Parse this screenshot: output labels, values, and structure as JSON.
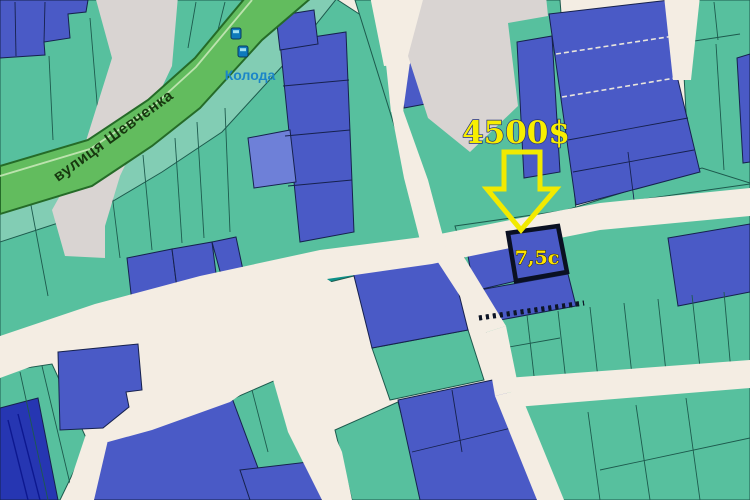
{
  "map": {
    "labels": {
      "street": "вулиця Шевченка",
      "place": "Колода",
      "price": "4500$",
      "area": "7,5с"
    },
    "colors": {
      "blue": "#4a5ac6",
      "blue_light": "#6e80d8",
      "blue_dark": "#2636b2",
      "navy_line": "#16214d",
      "green": "#57c09e",
      "green_hl": "#82cdb4",
      "green_dark": "#0c9189",
      "green_line": "#1d5a4d",
      "road": "#f4ede3",
      "road_gray": "#d9d4d2",
      "band": "#62bc5e",
      "band_edge": "#256b28",
      "band_light": "#cdeabc",
      "street_text": "#17380f",
      "place_text": "#1b86c8",
      "price_fill": "#f8ee00",
      "price_outline": "#22307c",
      "arrow_yellow": "#f2ea00",
      "hatch": "#0d1526",
      "white_dash": "#e9e5dc",
      "target_border": "#0a1022"
    },
    "parcels": [
      {
        "p": "0,0 310,0 0,235",
        "f": "green"
      },
      {
        "p": "0,195 330,-5 430,60 446,246 310,272 120,316 0,346",
        "f": "green"
      },
      {
        "p": "355,0 560,0 576,212 430,240",
        "f": "green"
      },
      {
        "p": "680,0 750,0 750,206 690,188",
        "f": "green"
      },
      {
        "p": "560,212 702,168 750,183 750,196 600,208",
        "f": "green"
      },
      {
        "p": "455,226 750,184 750,368 508,406",
        "f": "green"
      },
      {
        "p": "510,400 750,370 750,500 545,500",
        "f": "green"
      },
      {
        "p": "0,372 52,364 88,442 60,500 0,500",
        "f": "green"
      },
      {
        "p": "230,400 292,373 325,462 240,472",
        "f": "green"
      },
      {
        "p": "335,430 398,402 424,500 352,500",
        "f": "green"
      },
      {
        "p": "372,348 468,330 484,380 390,400",
        "f": "green"
      },
      {
        "p": "0,214 92,186 152,146 200,108 262,40 318,-8 342,-8 286,62 222,132 162,172 98,210 0,242",
        "f": "green_hl"
      },
      {
        "p": "0,0 88,0 86,12 68,14 70,38 44,42 45,55 0,58",
        "f": "blue"
      },
      {
        "p": "280,42 346,32 354,232 300,242",
        "f": "blue"
      },
      {
        "p": "248,138 290,130 296,182 254,188",
        "f": "blue_light"
      },
      {
        "p": "276,16 314,10 318,44 280,50",
        "f": "blue"
      },
      {
        "p": "127,258 172,249 180,312 134,320",
        "f": "blue"
      },
      {
        "p": "172,249 212,242 220,305 180,312",
        "f": "blue"
      },
      {
        "p": "212,242 236,237 243,270 221,275",
        "f": "blue"
      },
      {
        "p": "268,262 388,242 394,266 298,290",
        "f": "green_dark"
      },
      {
        "p": "352,268 448,250 468,330 372,348",
        "f": "blue"
      },
      {
        "p": "398,55 440,47 447,100 404,108",
        "f": "blue"
      },
      {
        "p": "452,28 502,21 511,100 460,112",
        "f": "blue"
      },
      {
        "p": "517,42 552,36 560,172 524,178",
        "f": "blue"
      },
      {
        "p": "549,14 670,0 678,80 700,172 576,205",
        "f": "blue"
      },
      {
        "p": "737,58 750,54 750,162 743,163",
        "f": "blue"
      },
      {
        "p": "668,238 750,224 750,292 678,306",
        "f": "blue"
      },
      {
        "p": "466,244 508,236 516,281 474,291",
        "f": "blue"
      },
      {
        "p": "474,291 568,274 576,306 484,323",
        "f": "blue"
      },
      {
        "p": "398,400 502,378 540,500 420,500",
        "f": "blue"
      },
      {
        "p": "100,438 232,398 258,468 256,500 88,500",
        "f": "blue"
      },
      {
        "p": "240,470 325,460 338,500 250,500",
        "f": "blue"
      },
      {
        "p": "0,408 38,398 58,500 0,500",
        "f": "blue_dark"
      }
    ],
    "roads": [
      {
        "p": "0,336 95,304 200,276 320,250 430,236 510,220 600,203 750,188 750,216 600,230 510,248 432,264 320,280 200,306 98,342 0,378",
        "f": "road"
      },
      {
        "p": "370,-4 428,-4 410,64 384,66",
        "f": "road"
      },
      {
        "p": "386,64 410,62 403,112 391,112",
        "f": "road"
      },
      {
        "p": "391,110 403,110 428,180 444,240 422,248 404,178",
        "f": "road"
      },
      {
        "p": "430,250 456,244 506,326 484,333",
        "f": "road"
      },
      {
        "p": "484,333 506,326 519,390 495,396",
        "f": "road"
      },
      {
        "p": "495,396 519,390 564,500 537,500",
        "f": "road"
      },
      {
        "p": "507,378 750,360 750,388 516,407",
        "f": "road"
      },
      {
        "p": "86,312 230,286 302,262 346,292 300,344 256,384 230,402 152,430 108,442 86,434 90,376 82,342",
        "f": "road"
      },
      {
        "p": "268,362 298,352 342,452 352,500 322,500 288,432",
        "f": "road"
      },
      {
        "p": "86,434 108,440 94,500 64,500",
        "f": "road"
      },
      {
        "p": "664,-4 700,-4 691,80 673,80",
        "f": "road"
      },
      {
        "p": "424,-4 546,-4 548,16 508,23 518,106 470,152 428,118 408,56",
        "f": "road_gray"
      },
      {
        "p": "95,-4 178,-4 172,66 120,176 105,226 105,258 65,256 52,210 80,160 112,58",
        "f": "road_gray"
      }
    ],
    "border_lines": [
      {
        "x1": 30,
        "y1": 200,
        "x2": 48,
        "y2": 296,
        "c": "gl"
      },
      {
        "x1": 110,
        "y1": 178,
        "x2": 120,
        "y2": 258,
        "c": "gl"
      },
      {
        "x1": 143,
        "y1": 155,
        "x2": 152,
        "y2": 250,
        "c": "gl"
      },
      {
        "x1": 175,
        "y1": 138,
        "x2": 182,
        "y2": 243,
        "c": "gl"
      },
      {
        "x1": 197,
        "y1": 122,
        "x2": 204,
        "y2": 238,
        "c": "gl"
      },
      {
        "x1": 225,
        "y1": 108,
        "x2": 230,
        "y2": 232,
        "c": "gl"
      },
      {
        "x1": 49,
        "y1": 56,
        "x2": 53,
        "y2": 140,
        "c": "gl"
      },
      {
        "x1": 90,
        "y1": 18,
        "x2": 100,
        "y2": 138,
        "c": "gl"
      },
      {
        "x1": 196,
        "y1": 2,
        "x2": 188,
        "y2": 48,
        "c": "gl"
      },
      {
        "x1": 225,
        "y1": 2,
        "x2": 218,
        "y2": 30,
        "c": "gl"
      },
      {
        "x1": 527,
        "y1": 315,
        "x2": 537,
        "y2": 402,
        "c": "gl"
      },
      {
        "x1": 558,
        "y1": 311,
        "x2": 568,
        "y2": 399,
        "c": "gl"
      },
      {
        "x1": 590,
        "y1": 307,
        "x2": 600,
        "y2": 396,
        "c": "gl"
      },
      {
        "x1": 624,
        "y1": 303,
        "x2": 634,
        "y2": 393,
        "c": "gl"
      },
      {
        "x1": 658,
        "y1": 299,
        "x2": 668,
        "y2": 390,
        "c": "gl"
      },
      {
        "x1": 692,
        "y1": 295,
        "x2": 702,
        "y2": 386,
        "c": "gl"
      },
      {
        "x1": 724,
        "y1": 292,
        "x2": 732,
        "y2": 383,
        "c": "gl"
      },
      {
        "x1": 492,
        "y1": 350,
        "x2": 560,
        "y2": 338,
        "c": "gl"
      },
      {
        "x1": 588,
        "y1": 412,
        "x2": 600,
        "y2": 500,
        "c": "gl"
      },
      {
        "x1": 636,
        "y1": 405,
        "x2": 650,
        "y2": 500,
        "c": "gl"
      },
      {
        "x1": 686,
        "y1": 398,
        "x2": 700,
        "y2": 500,
        "c": "gl"
      },
      {
        "x1": 600,
        "y1": 470,
        "x2": 750,
        "y2": 438,
        "c": "gl"
      },
      {
        "x1": 714,
        "y1": 2,
        "x2": 718,
        "y2": 40,
        "c": "gl"
      },
      {
        "x1": 688,
        "y1": 42,
        "x2": 740,
        "y2": 34,
        "c": "gl"
      },
      {
        "x1": 716,
        "y1": 44,
        "x2": 724,
        "y2": 170,
        "c": "gl"
      },
      {
        "x1": 20,
        "y1": 372,
        "x2": 48,
        "y2": 500,
        "c": "gl"
      },
      {
        "x1": 42,
        "y1": 366,
        "x2": 72,
        "y2": 492,
        "c": "gl"
      },
      {
        "x1": 252,
        "y1": 390,
        "x2": 268,
        "y2": 452,
        "c": "gl"
      },
      {
        "x1": 15,
        "y1": 2,
        "x2": 16,
        "y2": 56,
        "c": "nv"
      },
      {
        "x1": 45,
        "y1": 2,
        "x2": 44,
        "y2": 42,
        "c": "nv"
      },
      {
        "x1": 283,
        "y1": 86,
        "x2": 349,
        "y2": 80,
        "c": "nv"
      },
      {
        "x1": 285,
        "y1": 136,
        "x2": 350,
        "y2": 130,
        "c": "nv"
      },
      {
        "x1": 288,
        "y1": 186,
        "x2": 352,
        "y2": 180,
        "c": "nv"
      },
      {
        "x1": 412,
        "y1": 452,
        "x2": 528,
        "y2": 424,
        "c": "nv"
      },
      {
        "x1": 452,
        "y1": 390,
        "x2": 462,
        "y2": 452,
        "c": "nv"
      },
      {
        "x1": 568,
        "y1": 140,
        "x2": 688,
        "y2": 118,
        "c": "nv"
      },
      {
        "x1": 573,
        "y1": 172,
        "x2": 694,
        "y2": 150,
        "c": "nv"
      },
      {
        "x1": 628,
        "y1": 152,
        "x2": 634,
        "y2": 200,
        "c": "nv"
      },
      {
        "x1": 8,
        "y1": 420,
        "x2": 28,
        "y2": 500,
        "c": "nd"
      },
      {
        "x1": 18,
        "y1": 414,
        "x2": 40,
        "y2": 500,
        "c": "nd"
      },
      {
        "x1": 556,
        "y1": 54,
        "x2": 674,
        "y2": 36,
        "c": "wd"
      },
      {
        "x1": 562,
        "y1": 97,
        "x2": 681,
        "y2": 77,
        "c": "wd"
      },
      {
        "x1": 479,
        "y1": 318,
        "x2": 584,
        "y2": 303,
        "c": "hatch"
      }
    ],
    "highlight_parcels": [
      {
        "p": "58,352 138,344 142,390 126,392 129,407 103,428 60,430",
        "f": "blue",
        "thick": false
      },
      {
        "p": "508,233 558,226 567,272 516,281",
        "f": "blue",
        "thick": true
      }
    ],
    "street_band": {
      "body": "0,166 88,140 148,100 195,58 250,-8 318,-8 262,40 200,108 152,146 92,186 0,214",
      "light_edge": "0,176 90,149 150,109 196,67 252,0"
    },
    "arrow": {
      "path": "M504,152 L540,152 L540,189 L556,189 L521,230 L487,189 L504,189 Z"
    }
  }
}
